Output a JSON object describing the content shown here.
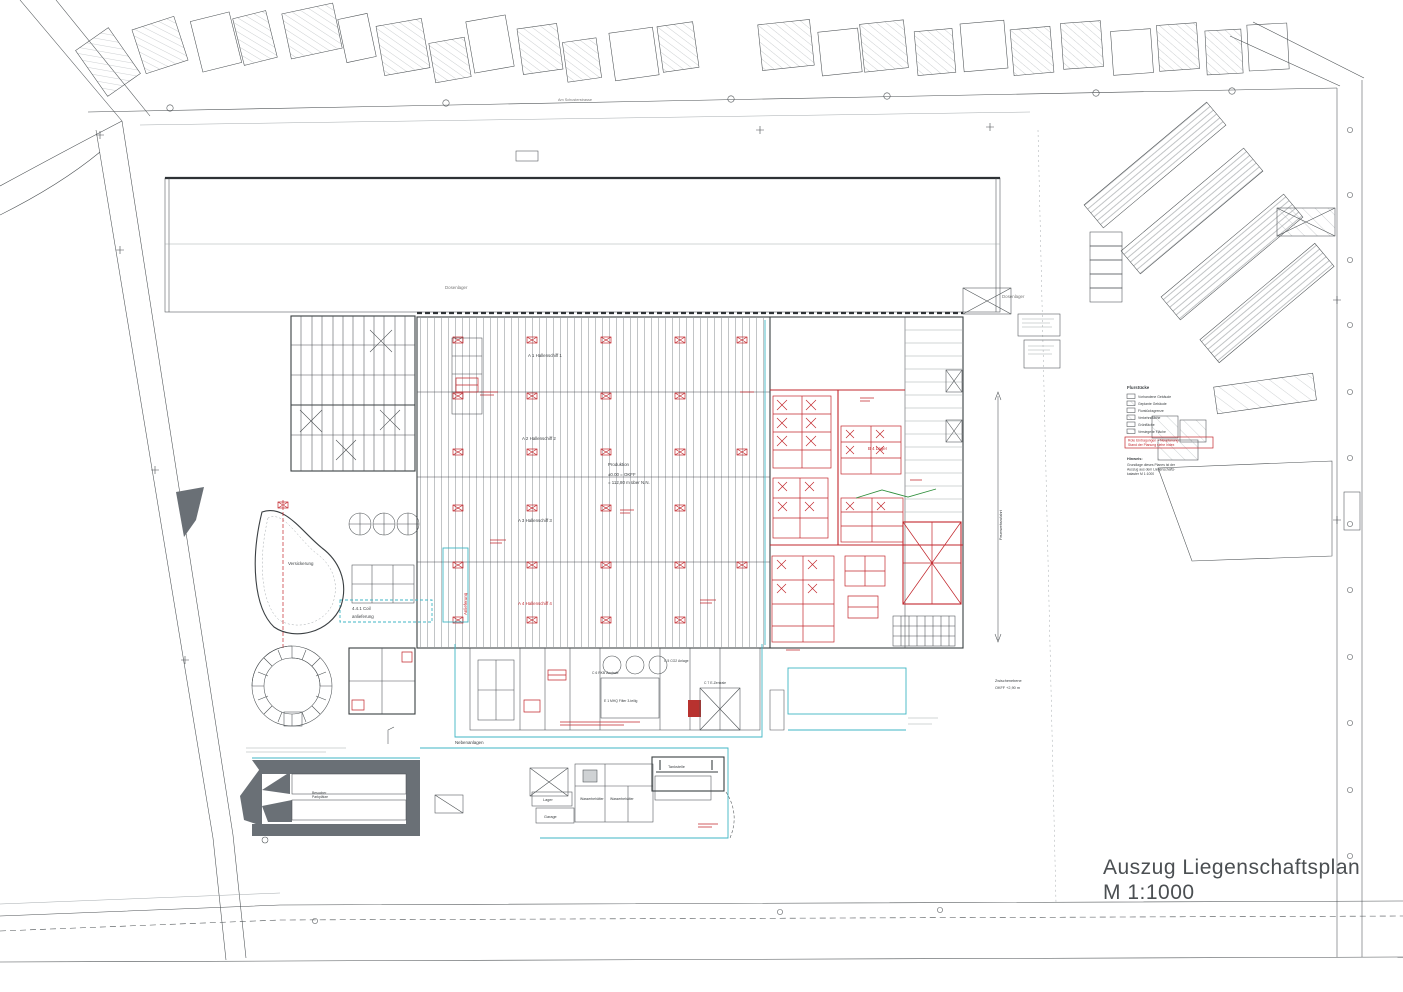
{
  "title": {
    "line1": "Auszug Liegenschaftsplan",
    "line2": "M 1:1000"
  },
  "colors": {
    "ink": "#4a4f52",
    "red": "#c2272d",
    "cyan": "#3fb6c4",
    "green": "#2f8f3c",
    "gray_fill": "#6a7076",
    "tan_fill": "#ecc79f",
    "yellow": "#e8d88f"
  },
  "site": {
    "street_top": "Am Schusterstrasse",
    "dosenlager_left": "Dosenlager",
    "dosenlager_right": "Dosenlager",
    "halls": {
      "h1": "A 1 Hallenschiff 1",
      "h2": "A 2 Hallenschiff 2",
      "h3": "A 3 Hallenschiff 3",
      "h4": "A 4 Hallenschiff 4"
    },
    "b4": "B 4 Lager",
    "produktion": {
      "line1": "Produktion",
      "line2": "±0.00 = OKFF",
      "line3": "= 112,80 m über N.N."
    },
    "versickerung": "Versickerung",
    "coil": {
      "line1": "4.4.1 Coil",
      "line2": "anlieferung"
    },
    "anlieferung": "Anlieferung",
    "nebenanlagen": "Nebenanlagen",
    "zwischenebene": {
      "line1": "Zwischenebene",
      "line2": "OKFF +2,90 m"
    },
    "feuerwehr": "Feuerwehrzufahrt",
    "tankstelle": "Tankstelle",
    "lager": "Lager",
    "garage": "Garage",
    "wasser1": "Wasserbehälter",
    "wasser2": "Wasserbehälter",
    "parkplaetze": {
      "line1": "Besucher",
      "line2": "Parkplätze"
    },
    "rkb": "C 6 RKB Zentrale",
    "filter": "E 1 MHQ Filter 3-teilig",
    "co2": "C 5 CO2 Anlage",
    "ezentrale": "C 7 E-Zentrale"
  },
  "legend": {
    "header": "Flurstücke",
    "items": [
      "Vorhandene Gebäude",
      "Geplante Gebäude",
      "Flurstücksgrenze",
      "Verkehrsfläche",
      "Grünfläche",
      "Versiegelte Fläche"
    ]
  },
  "red_note": {
    "line1": "Rote Eintragungen = Neuplanung",
    "line2": "Stand der Planung siehe Index"
  },
  "hinweis": {
    "header": "Hinweis:",
    "line1": "Grundlage dieses Planes ist der",
    "line2": "Auszug aus dem Liegenschafts-",
    "line3": "kataster M 1:1000"
  }
}
